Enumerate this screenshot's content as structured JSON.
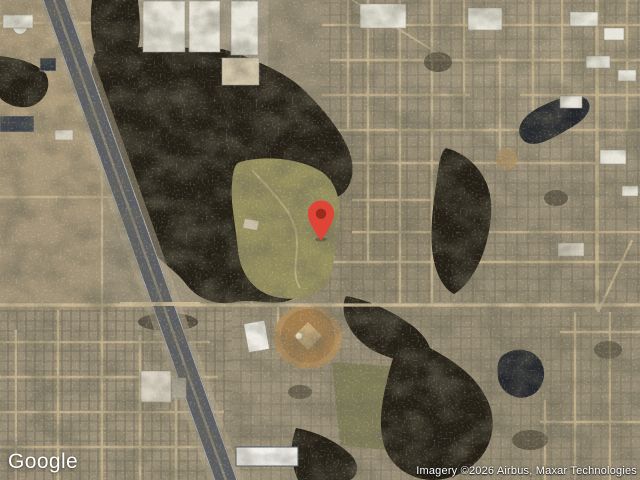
{
  "map": {
    "view": "satellite",
    "google_logo": "Google",
    "attribution": "Imagery ©2026 Airbus, Maxar Technologies",
    "marker": {
      "icon": "red-map-pin",
      "pin_color": "#DE4537",
      "pin_dot_color": "#9A2B1F"
    },
    "palette": {
      "street": "#c9b68f",
      "main_road": "#cfbd97",
      "woods": "#252117",
      "water": "#23262c",
      "highway_asphalt": "#5d5f63",
      "building_roof": "#eceade",
      "park_meadow": "#98915f",
      "ballfield_dirt": "#a5804f"
    }
  }
}
